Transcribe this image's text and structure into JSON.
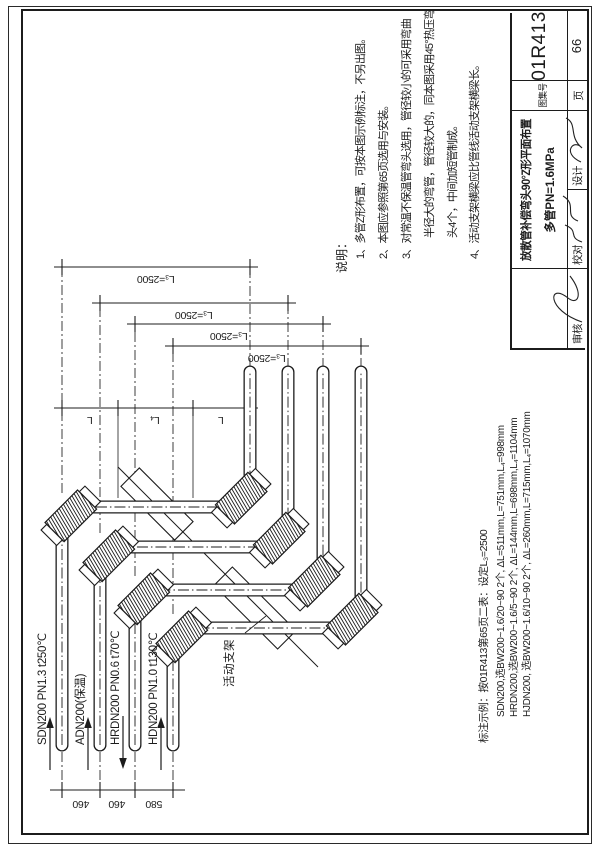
{
  "title_block": {
    "title_line1": "放散管补偿弯头90°Z形平面布置",
    "title_line2": "多管PN=1.6MPa",
    "atlas_label": "图集号",
    "atlas_no": "01R413",
    "page_label": "页",
    "page_no": "66",
    "signs": [
      "审核",
      "校对",
      "设计"
    ]
  },
  "notes": {
    "heading": "说明：",
    "items": [
      "1、多管Z形布置，可按本图示例标注，不另出图。",
      "2、本图应参照第65页选用与安装。",
      "3、对常温不保温管弯头选用，管径较小的可采用弯曲",
      "半径大的弯管，管径较大的，同本图采用45°热压弯",
      "头4个，中间加短管制成。",
      "4、活动支架横梁应比管线活动支架横梁长。"
    ]
  },
  "legend": {
    "header": "标注示例：按01R413第65页二表：设定L₃=2500",
    "rows": [
      "SDN200,选BW200~1.6/20~90  2个,  ΔL=511mm,L=751mm,L₄=998mm",
      "HRDN200,选BW200~1.6/5~90  2个,  ΔL=144mm,L=698mm,L₄=1104mm",
      "HJDN200, 选BW200~1.6/10~90  2个,  ΔL=260mm,L=715mm,L₄=1070mm"
    ]
  },
  "pipes": [
    {
      "label": "SDN200 PN1.3 t250℃",
      "flow": "in"
    },
    {
      "label": "ADN200(保温)",
      "flow": "in"
    },
    {
      "label": "HRDN200 PN0.6 t70℃",
      "flow": "out"
    },
    {
      "label": "HDN200 PN1.0 t130℃",
      "flow": "in"
    }
  ],
  "dimensions": {
    "offset_label": "L₃=2500",
    "spacing": [
      "460",
      "460",
      "580"
    ],
    "segment_labels": [
      "L",
      "L₄",
      "L"
    ],
    "support_label": "活动支架"
  }
}
